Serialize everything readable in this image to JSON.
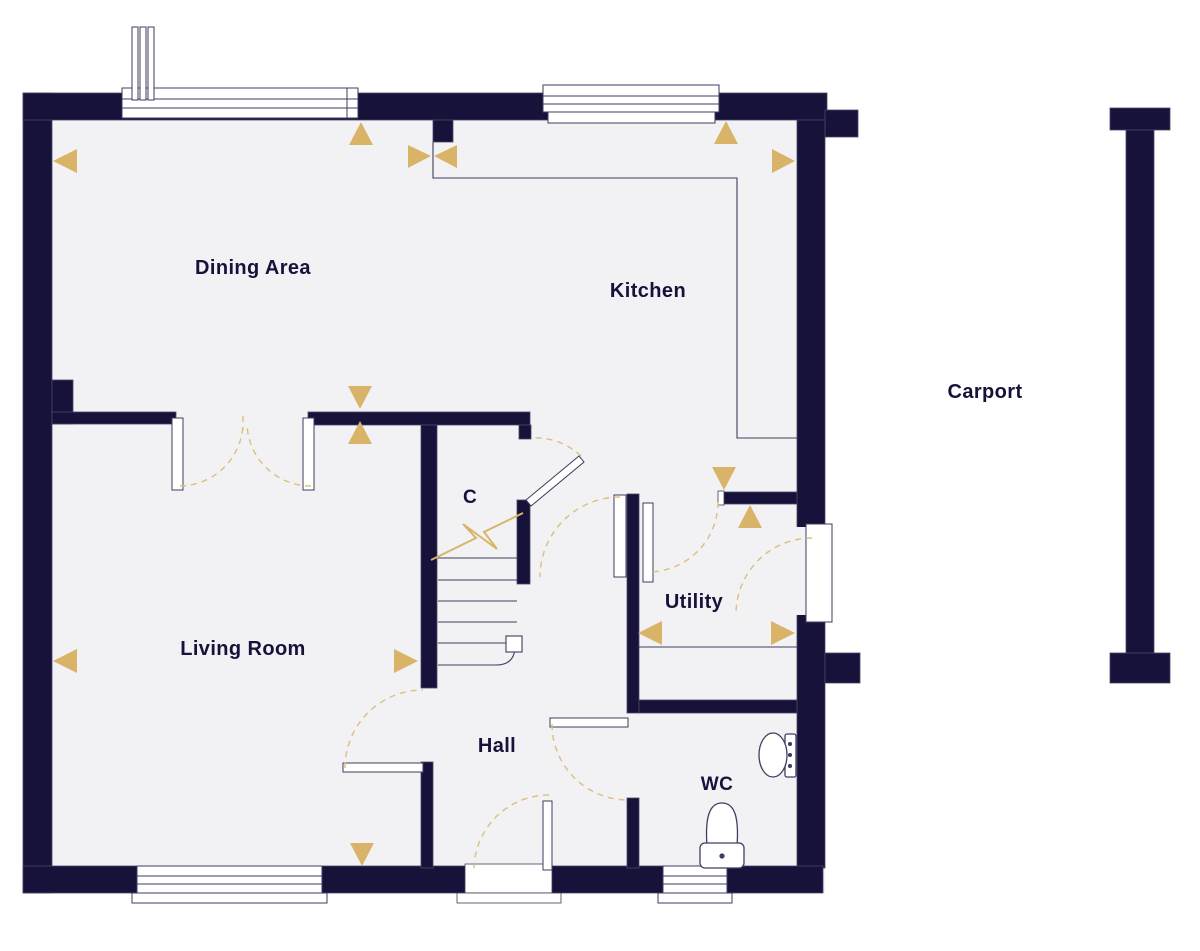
{
  "colors": {
    "wall": "#17123a",
    "floor": "#f2f2f4",
    "outside": "#ffffff",
    "accent": "#d9b468",
    "arc": "#ddbe7d",
    "thin": "#3e3e60",
    "label": "#17123a"
  },
  "rooms": {
    "dining": {
      "label": "Dining Area"
    },
    "kitchen": {
      "label": "Kitchen"
    },
    "living": {
      "label": "Living Room"
    },
    "hall": {
      "label": "Hall"
    },
    "utility": {
      "label": "Utility"
    },
    "wc": {
      "label": "WC"
    },
    "cupboard": {
      "label": "C"
    },
    "carport": {
      "label": "Carport"
    }
  },
  "icons": [
    "window-icon",
    "door-swing-icon",
    "staircase-icon",
    "break-line-icon",
    "toilet-icon",
    "basin-icon",
    "measure-arrow-icon",
    "flue-icon"
  ]
}
